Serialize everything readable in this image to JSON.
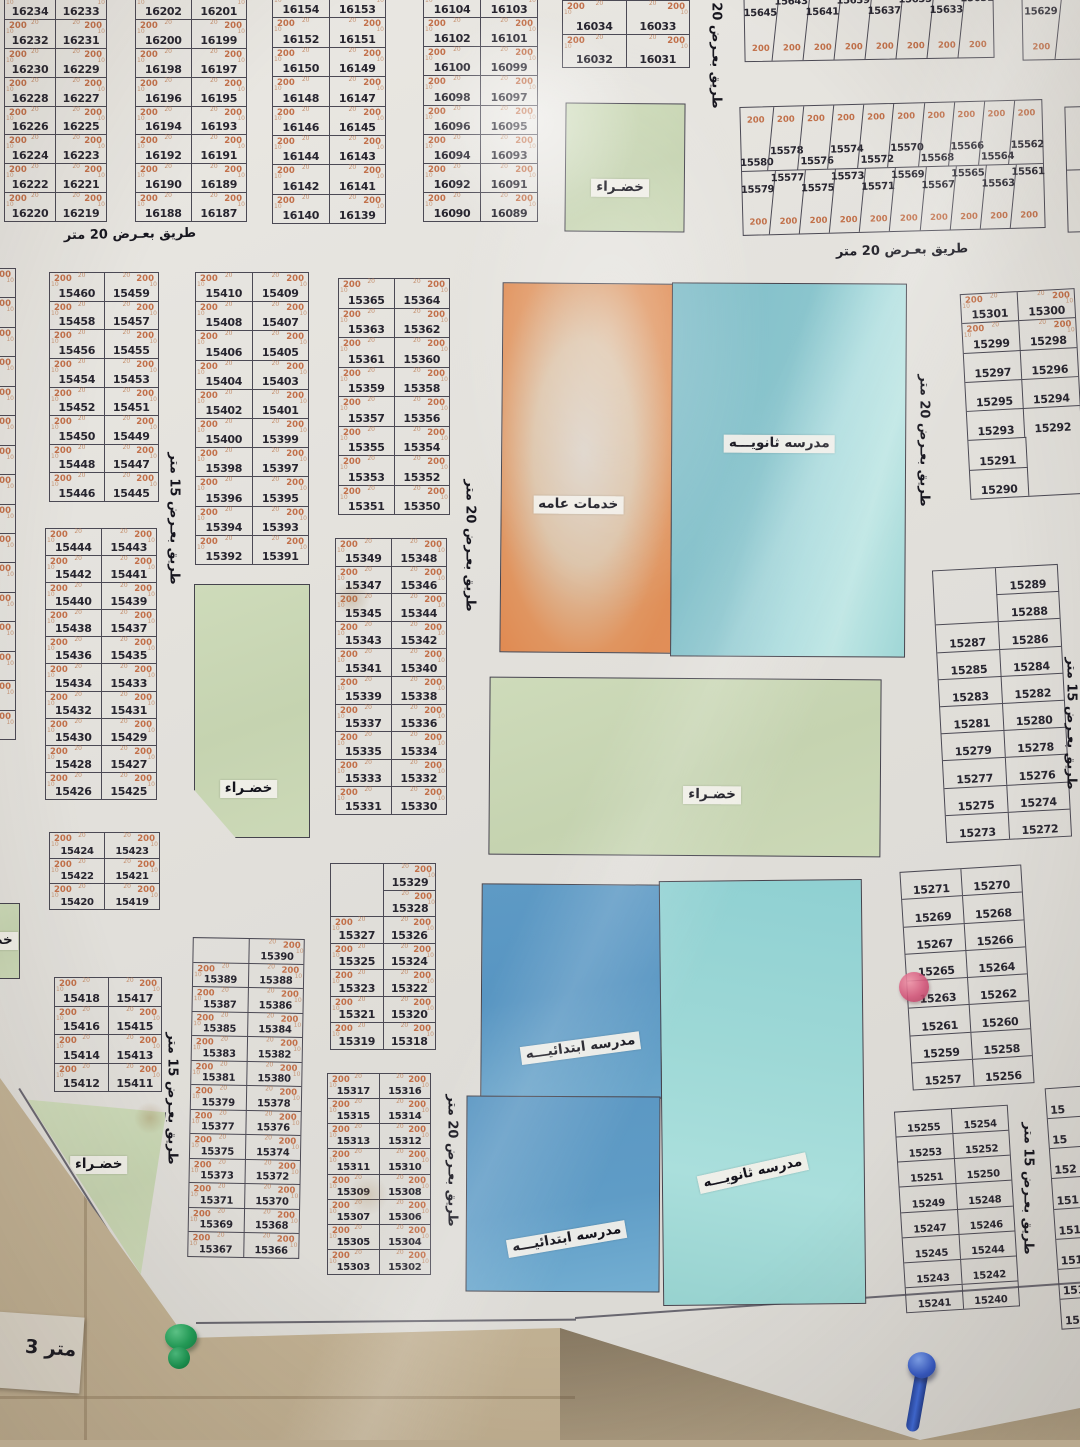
{
  "labels": {
    "area": "200",
    "dim20": "20",
    "dim10": "10",
    "green": "خضـراء",
    "services": "خدمات عامه",
    "secondary_school": "مدرسه ثانويـــه",
    "primary_school": "مدرسه ابتدائيـــه",
    "road20": "طريق بعـرض 20 متر",
    "road15": "طريق بعـرض 15 متر",
    "bottom_fragment": "3 متر"
  },
  "blocks": [
    {
      "id": "b16234",
      "x": 4,
      "y": -10,
      "w": 101,
      "h": 230,
      "s200": true,
      "rows": [
        [
          "16234",
          "16233"
        ],
        [
          "16232",
          "16231"
        ],
        [
          "16230",
          "16229"
        ],
        [
          "16228",
          "16227"
        ],
        [
          "16226",
          "16225"
        ],
        [
          "16224",
          "16223"
        ],
        [
          "16222",
          "16221"
        ],
        [
          "16220",
          "16219"
        ]
      ]
    },
    {
      "id": "b16202",
      "x": 135,
      "y": -10,
      "w": 110,
      "h": 230,
      "s200": true,
      "rows": [
        [
          "16202",
          "16201"
        ],
        [
          "16200",
          "16199"
        ],
        [
          "16198",
          "16197"
        ],
        [
          "16196",
          "16195"
        ],
        [
          "16194",
          "16193"
        ],
        [
          "16192",
          "16191"
        ],
        [
          "16190",
          "16189"
        ],
        [
          "16188",
          "16187"
        ]
      ]
    },
    {
      "id": "b16154",
      "x": 272,
      "y": -12,
      "w": 112,
      "h": 234,
      "s200": true,
      "rows": [
        [
          "16154",
          "16153"
        ],
        [
          "16152",
          "16151"
        ],
        [
          "16150",
          "16149"
        ],
        [
          "16148",
          "16147"
        ],
        [
          "16146",
          "16145"
        ],
        [
          "16144",
          "16143"
        ],
        [
          "16142",
          "16141"
        ],
        [
          "16140",
          "16139"
        ]
      ]
    },
    {
      "id": "b16104",
      "x": 423,
      "y": -12,
      "w": 113,
      "h": 232,
      "s200": true,
      "rows": [
        [
          "16104",
          "16103"
        ],
        [
          "16102",
          "16101"
        ],
        [
          "16100",
          "16099"
        ],
        [
          "16098",
          "16097"
        ],
        [
          "16096",
          "16095"
        ],
        [
          "16094",
          "16093"
        ],
        [
          "16092",
          "16091"
        ],
        [
          "16090",
          "16089"
        ]
      ]
    },
    {
      "id": "b16034",
      "x": 562,
      "y": 0,
      "w": 126,
      "h": 66,
      "s200": true,
      "rows": [
        [
          "16034",
          "16033"
        ],
        [
          "16032",
          "16031"
        ]
      ]
    },
    {
      "id": "b15645",
      "type": "strip",
      "x": 744,
      "y": -8,
      "w": 248,
      "h": 66,
      "rot": -1,
      "s200": true,
      "strips": [
        {
          "numpos": "top",
          "cells": [
            "15645",
            "15643",
            "15641",
            "15639",
            "15637",
            "15635",
            "15633",
            "15631"
          ]
        }
      ]
    },
    {
      "id": "b15629",
      "type": "strip",
      "x": 1022,
      "y": -8,
      "w": 72,
      "h": 66,
      "rot": -1,
      "s200": true,
      "strips": [
        {
          "numpos": "top",
          "cells": [
            "15629",
            ""
          ]
        }
      ]
    },
    {
      "id": "b15580",
      "type": "strip",
      "x": 741,
      "y": 103,
      "w": 301,
      "h": 127,
      "rot": -1.5,
      "s200": true,
      "strips": [
        {
          "numpos": "bottom",
          "cells": [
            "15580",
            "15578",
            "15576",
            "15574",
            "15572",
            "15570",
            "15568",
            "15566",
            "15564",
            "15562"
          ]
        },
        {
          "numpos": "top",
          "cells": [
            "15579",
            "15577",
            "15575",
            "15573",
            "15571",
            "15569",
            "15567",
            "15565",
            "15563",
            "15561"
          ]
        }
      ]
    },
    {
      "id": "b-edge-top",
      "type": "strip",
      "x": 1066,
      "y": 106,
      "w": 46,
      "h": 124,
      "rot": -1.5,
      "s200": true,
      "strips": [
        {
          "numpos": "bottom",
          "cells": [
            "15"
          ]
        },
        {
          "numpos": "top",
          "cells": [
            "15"
          ]
        }
      ]
    },
    {
      "id": "b-sliver-left",
      "x": -94,
      "y": 268,
      "w": 108,
      "h": 470,
      "s200": true,
      "rows": [
        [
          "",
          ""
        ],
        [
          "",
          ""
        ],
        [
          "",
          ""
        ],
        [
          "",
          ""
        ],
        [
          "",
          ""
        ],
        [
          "",
          ""
        ],
        [
          "",
          ""
        ],
        [
          "",
          ""
        ],
        [
          "",
          ""
        ],
        [
          "",
          ""
        ],
        [
          "",
          ""
        ],
        [
          "",
          ""
        ],
        [
          "",
          ""
        ],
        [
          "",
          ""
        ],
        [
          "",
          ""
        ],
        [
          "",
          ""
        ]
      ]
    },
    {
      "id": "b15460",
      "x": 49,
      "y": 272,
      "w": 108,
      "h": 228,
      "s200": true,
      "rows": [
        [
          "15460",
          "15459"
        ],
        [
          "15458",
          "15457"
        ],
        [
          "15456",
          "15455"
        ],
        [
          "15454",
          "15453"
        ],
        [
          "15452",
          "15451"
        ],
        [
          "15450",
          "15449"
        ],
        [
          "15448",
          "15447"
        ],
        [
          "15446",
          "15445"
        ]
      ]
    },
    {
      "id": "b15444",
      "x": 45,
      "y": 528,
      "w": 110,
      "h": 270,
      "s200": true,
      "rows": [
        [
          "15444",
          "15443"
        ],
        [
          "15442",
          "15441"
        ],
        [
          "15440",
          "15439"
        ],
        [
          "15438",
          "15437"
        ],
        [
          "15436",
          "15435"
        ],
        [
          "15434",
          "15433"
        ],
        [
          "15432",
          "15431"
        ],
        [
          "15430",
          "15429"
        ],
        [
          "15428",
          "15427"
        ],
        [
          "15426",
          "15425"
        ]
      ]
    },
    {
      "id": "b15424",
      "x": 49,
      "y": 832,
      "w": 109,
      "h": 76,
      "s200": true,
      "rows": [
        [
          "15424",
          "15423"
        ],
        [
          "15422",
          "15421"
        ],
        [
          "15420",
          "15419"
        ]
      ]
    },
    {
      "id": "b15418",
      "x": 54,
      "y": 977,
      "w": 106,
      "h": 113,
      "s200": true,
      "rows": [
        [
          "15418",
          "15417"
        ],
        [
          "15416",
          "15415"
        ],
        [
          "15414",
          "15413"
        ],
        [
          "15412",
          "15411"
        ]
      ]
    },
    {
      "id": "b15410",
      "x": 195,
      "y": 272,
      "w": 112,
      "h": 291,
      "s200": true,
      "rows": [
        [
          "15410",
          "15409"
        ],
        [
          "15408",
          "15407"
        ],
        [
          "15406",
          "15405"
        ],
        [
          "15404",
          "15403"
        ],
        [
          "15402",
          "15401"
        ],
        [
          "15400",
          "15399"
        ],
        [
          "15398",
          "15397"
        ],
        [
          "15396",
          "15395"
        ],
        [
          "15394",
          "15393"
        ],
        [
          "15392",
          "15391"
        ]
      ]
    },
    {
      "id": "b15390",
      "x": 190,
      "y": 938,
      "w": 110,
      "h": 318,
      "rot": 1,
      "s200": true,
      "rows": [
        {
          "h": "R",
          "c": [
            "15390"
          ]
        },
        [
          "15389",
          "15388"
        ],
        [
          "15387",
          "15386"
        ],
        [
          "15385",
          "15384"
        ],
        [
          "15383",
          "15382"
        ],
        [
          "15381",
          "15380"
        ],
        [
          "15379",
          "15378"
        ],
        [
          "15377",
          "15376"
        ],
        [
          "15375",
          "15374"
        ],
        [
          "15373",
          "15372"
        ],
        [
          "15371",
          "15370"
        ],
        [
          "15369",
          "15368"
        ],
        [
          "15367",
          "15366"
        ]
      ]
    },
    {
      "id": "b15365",
      "x": 338,
      "y": 278,
      "w": 110,
      "h": 235,
      "s200": true,
      "rows": [
        [
          "15365",
          "15364"
        ],
        [
          "15363",
          "15362"
        ],
        [
          "15361",
          "15360"
        ],
        [
          "15359",
          "15358"
        ],
        [
          "15357",
          "15356"
        ],
        [
          "15355",
          "15354"
        ],
        [
          "15353",
          "15352"
        ],
        [
          "15351",
          "15350"
        ]
      ]
    },
    {
      "id": "b15349",
      "x": 335,
      "y": 538,
      "w": 110,
      "h": 275,
      "s200": true,
      "rows": [
        [
          "15349",
          "15348"
        ],
        [
          "15347",
          "15346"
        ],
        [
          "15345",
          "15344"
        ],
        [
          "15343",
          "15342"
        ],
        [
          "15341",
          "15340"
        ],
        [
          "15339",
          "15338"
        ],
        [
          "15337",
          "15336"
        ],
        [
          "15335",
          "15334"
        ],
        [
          "15333",
          "15332"
        ],
        [
          "15331",
          "15330"
        ]
      ]
    },
    {
      "id": "b15329",
      "x": 330,
      "y": 863,
      "w": 104,
      "h": 185,
      "s200": true,
      "rows": [
        {
          "h": "R",
          "c": [
            "15329"
          ]
        },
        {
          "h": "R",
          "c": [
            "15328"
          ]
        },
        [
          "15327",
          "15326"
        ],
        [
          "15325",
          "15324"
        ],
        [
          "15323",
          "15322"
        ],
        [
          "15321",
          "15320"
        ],
        [
          "15319",
          "15318"
        ]
      ]
    },
    {
      "id": "b15317",
      "x": 327,
      "y": 1073,
      "w": 102,
      "h": 200,
      "s200": true,
      "rows": [
        [
          "15317",
          "15316"
        ],
        [
          "15315",
          "15314"
        ],
        [
          "15313",
          "15312"
        ],
        [
          "15311",
          "15310"
        ],
        [
          "15309",
          "15308"
        ],
        [
          "15307",
          "15306"
        ],
        [
          "15305",
          "15304"
        ],
        [
          "15303",
          "15302"
        ]
      ]
    },
    {
      "id": "b15301",
      "x": 965,
      "y": 291,
      "w": 113,
      "h": 204,
      "rot": -3,
      "s200": 2,
      "rows": [
        [
          "15301",
          "15300"
        ],
        [
          "15299",
          "15298"
        ],
        [
          "15297",
          "15296"
        ],
        [
          "15295",
          "15294"
        ],
        [
          "15293",
          "15292"
        ],
        {
          "h": "L",
          "c": [
            "15291"
          ]
        },
        {
          "h": "L",
          "c": [
            "15290"
          ]
        }
      ]
    },
    {
      "id": "b15289",
      "x": 939,
      "y": 567,
      "w": 124,
      "h": 271,
      "rot": -3,
      "s200": 0,
      "rows": [
        {
          "h": "R",
          "c": [
            "15289"
          ]
        },
        {
          "h": "R",
          "c": [
            "15288"
          ]
        },
        [
          "15287",
          "15286"
        ],
        [
          "15285",
          "15284"
        ],
        [
          "15283",
          "15282"
        ],
        [
          "15281",
          "15280"
        ],
        [
          "15279",
          "15278"
        ],
        [
          "15277",
          "15276"
        ],
        [
          "15275",
          "15274"
        ],
        [
          "15273",
          "15272"
        ]
      ]
    },
    {
      "id": "b15271",
      "x": 906,
      "y": 868,
      "w": 120,
      "h": 217,
      "rot": -3.5,
      "s200": 0,
      "rows": [
        [
          "15271",
          "15270"
        ],
        [
          "15269",
          "15268"
        ],
        [
          "15267",
          "15266"
        ],
        [
          "15265",
          "15264"
        ],
        [
          "15263",
          "15262"
        ],
        [
          "15261",
          "15260"
        ],
        [
          "15259",
          "15258"
        ],
        [
          "15257",
          "15256"
        ]
      ]
    },
    {
      "id": "b15255",
      "x": 900,
      "y": 1108,
      "w": 112,
      "h": 200,
      "rot": -3.5,
      "s200": 0,
      "rows": [
        [
          "15255",
          "15254"
        ],
        [
          "15253",
          "15252"
        ],
        [
          "15251",
          "15250"
        ],
        [
          "15249",
          "15248"
        ],
        [
          "15247",
          "15246"
        ],
        [
          "15245",
          "15244"
        ],
        [
          "15243",
          "15242"
        ],
        [
          "15241",
          "15240"
        ]
      ]
    },
    {
      "id": "b-edge-right",
      "x": 1053,
      "y": 1085,
      "w": 85,
      "h": 240,
      "rot": -4,
      "s200": 0,
      "frag": true,
      "rows": [
        [
          "15"
        ],
        [
          "15"
        ],
        [
          "152"
        ],
        [
          "151"
        ],
        [
          "1519"
        ],
        [
          "1519"
        ],
        [
          "15196"
        ],
        [
          "15188"
        ]
      ]
    }
  ],
  "road_labels": [
    {
      "t": "road20",
      "x": 50,
      "y": 227,
      "vert": false,
      "rot": -1
    },
    {
      "t": "road20",
      "x": 822,
      "y": 243,
      "vert": false,
      "rot": -1.5
    },
    {
      "t": "road20",
      "cx": 716,
      "cy": 44,
      "vert": true
    },
    {
      "t": "road15",
      "cx": 174,
      "cy": 520,
      "vert": true
    },
    {
      "t": "road15",
      "cx": 172,
      "cy": 1100,
      "vert": true
    },
    {
      "t": "road20",
      "cx": 470,
      "cy": 547,
      "vert": true
    },
    {
      "t": "road20",
      "cx": 452,
      "cy": 1162,
      "vert": true
    },
    {
      "t": "road20",
      "cx": 924,
      "cy": 442,
      "vert": true
    },
    {
      "t": "road15",
      "cx": 1071,
      "cy": 725,
      "vert": true
    },
    {
      "t": "road15",
      "cx": 1028,
      "cy": 1190,
      "vert": true
    }
  ],
  "zones": [
    {
      "k": "green",
      "x": 565,
      "y": 103,
      "w": 118,
      "h": 127,
      "rot": 0.5,
      "lx": 46,
      "ly": 66,
      "label": "green"
    },
    {
      "k": "services",
      "x": 501,
      "y": 283,
      "w": 170,
      "h": 368,
      "rot": 0.5,
      "lx": 45,
      "ly": 60,
      "label": "services"
    },
    {
      "k": "school-teal",
      "x": 671,
      "y": 283,
      "w": 233,
      "h": 372,
      "rot": 0.3,
      "lx": 46,
      "ly": 43,
      "label": "secondary"
    },
    {
      "k": "green",
      "x": 489,
      "y": 678,
      "w": 390,
      "h": 176,
      "rot": 0.4,
      "lx": 57,
      "ly": 66,
      "label": "green"
    },
    {
      "k": "green",
      "x": 194,
      "y": 584,
      "w": 114,
      "h": 252,
      "rot": 0,
      "clip": "polygon(0 0,100% 0,100% 100%,36% 100%,0 81%)",
      "lx": 47,
      "ly": 81,
      "label": "green"
    },
    {
      "k": "green",
      "x": 26,
      "y": 1096,
      "w": 138,
      "h": 180,
      "rot": 0,
      "clip": "polygon(1% 2%,100% 9%,82% 98%)",
      "lx": 52,
      "ly": 38,
      "label": "green"
    },
    {
      "k": "green",
      "x": -42,
      "y": 903,
      "w": 60,
      "h": 74,
      "rot": 0,
      "lx": 50,
      "ly": 50,
      "label": "green"
    },
    {
      "k": "school-blue",
      "x": 481,
      "y": 884,
      "w": 180,
      "h": 212,
      "rot": 0.4,
      "lx": 55,
      "ly": 77,
      "lrot": -8,
      "label": "primary"
    },
    {
      "k": "school-blue2",
      "x": 466,
      "y": 1096,
      "w": 192,
      "h": 194,
      "rot": 0.3,
      "lx": 52,
      "ly": 73,
      "lrot": -10,
      "label": "primary"
    },
    {
      "k": "school-teal2",
      "x": 661,
      "y": 880,
      "w": 201,
      "h": 423,
      "rot": -0.6,
      "lx": 45,
      "ly": 69,
      "lrot": -12,
      "label": "secondary"
    }
  ],
  "pins": [
    {
      "k": "red",
      "x": 914,
      "y": 987
    },
    {
      "k": "green",
      "x": 183,
      "y": 1338
    },
    {
      "k": "blue",
      "x": 912,
      "y": 1386
    }
  ]
}
